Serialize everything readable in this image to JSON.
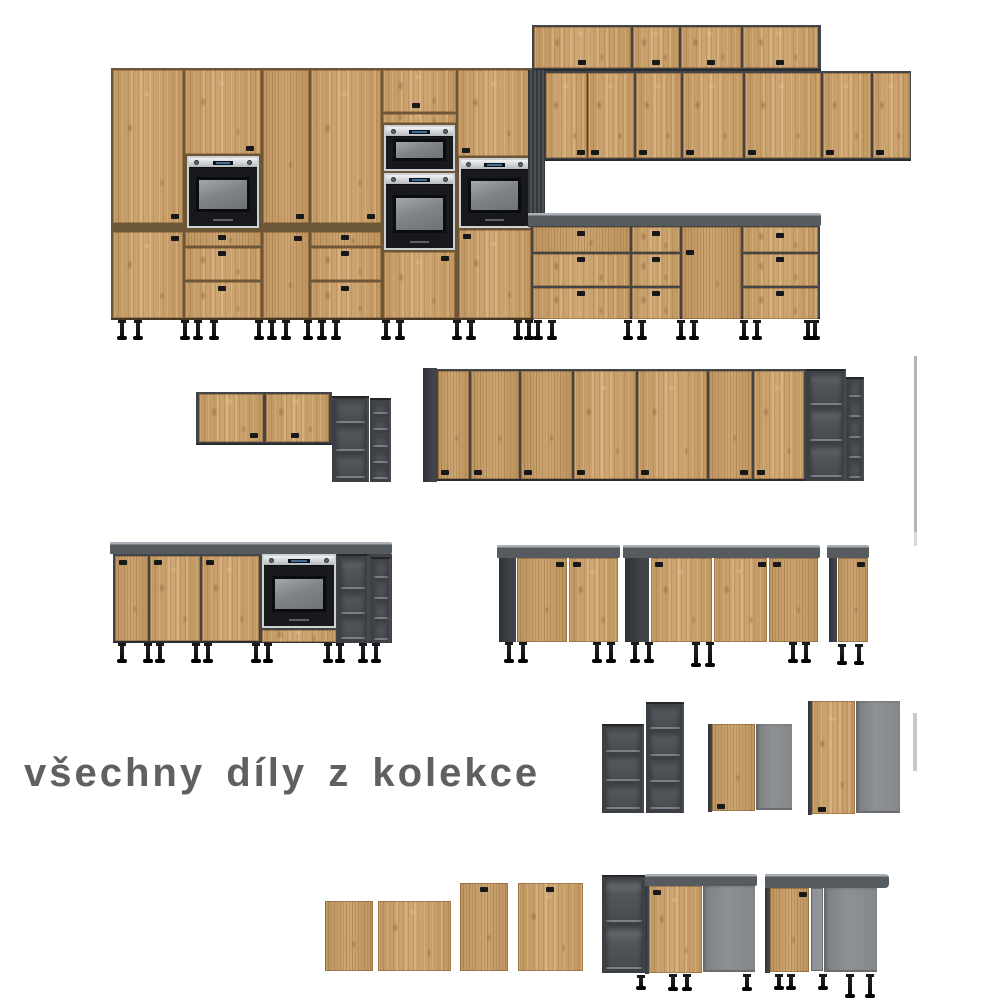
{
  "caption": {
    "text": "všechny díly z kolekce"
  },
  "colors": {
    "background": "#ffffff",
    "wood": "#c99e66",
    "carcass": "#41454a",
    "shelf-frame": "#3c4044",
    "shelf-cell": "#474b4f",
    "counter": "#565b60",
    "counter-edge": "#aab0b5",
    "panel-gray": "#8e9194",
    "oven-black": "#17191c",
    "display-blue": "#4f7fae",
    "handle": "#17181a",
    "leg": "#0d0d0f",
    "strip": "#b2b5b7",
    "caption-color": "#606060"
  }
}
